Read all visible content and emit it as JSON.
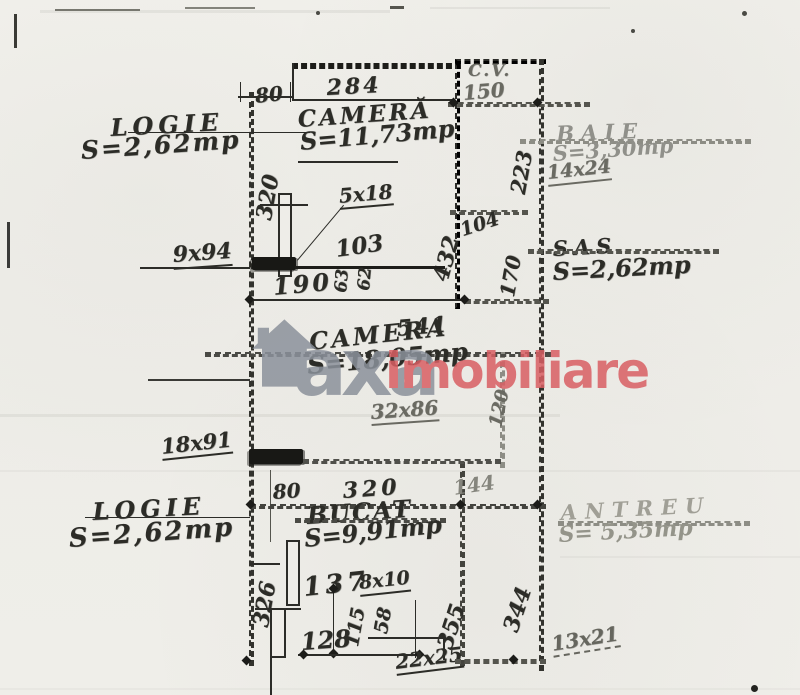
{
  "watermark": {
    "brand_gray_text": "axa",
    "brand_red_text": "imobiliare",
    "gray_color": "#8b919b",
    "red_color": "#d95f63"
  },
  "rooms": {
    "logie_top": {
      "name": "LOGIE",
      "area": "S=2,62mp"
    },
    "camera_top": {
      "name": "CAMERĂ",
      "area": "S=11,73mp"
    },
    "cv": {
      "name": "C.V."
    },
    "baie": {
      "name": "BAIE",
      "area": "S=3,30mp"
    },
    "sas": {
      "name": "SAS",
      "area": "S=2,62mp"
    },
    "camera_main": {
      "name": "CAMERA",
      "area": "S=18,05mp"
    },
    "logie_bottom": {
      "name": "LOGIE",
      "area": "S=2,62mp"
    },
    "bucatarie": {
      "name": "BUCAT",
      "area": "S=9,91mp"
    },
    "antreu": {
      "name": "ANTREU",
      "area": "S= 5,35mp"
    }
  },
  "dims": {
    "d80_top": "80",
    "d284": "284",
    "d150": "150",
    "d223": "223",
    "d320_left": "320",
    "d5x18": "5x18",
    "d432": "432",
    "d104": "104",
    "d170": "170",
    "d14x24": "14x24",
    "d9x94": "9x94",
    "d103": "103",
    "d63": "63",
    "d62": "62",
    "d190": "190",
    "d541": "541",
    "d120": "120",
    "d32x86": "32x86",
    "d18x91": "18x91",
    "d80_bottom": "80",
    "d320_bottom": "320",
    "d144": "144",
    "d326": "326",
    "d137": "137",
    "d8x10": "8x10",
    "d355": "355",
    "d344": "344",
    "d115": "115",
    "d58": "58",
    "d128": "128",
    "d22x25": "22x25",
    "d13x21": "13x21"
  }
}
